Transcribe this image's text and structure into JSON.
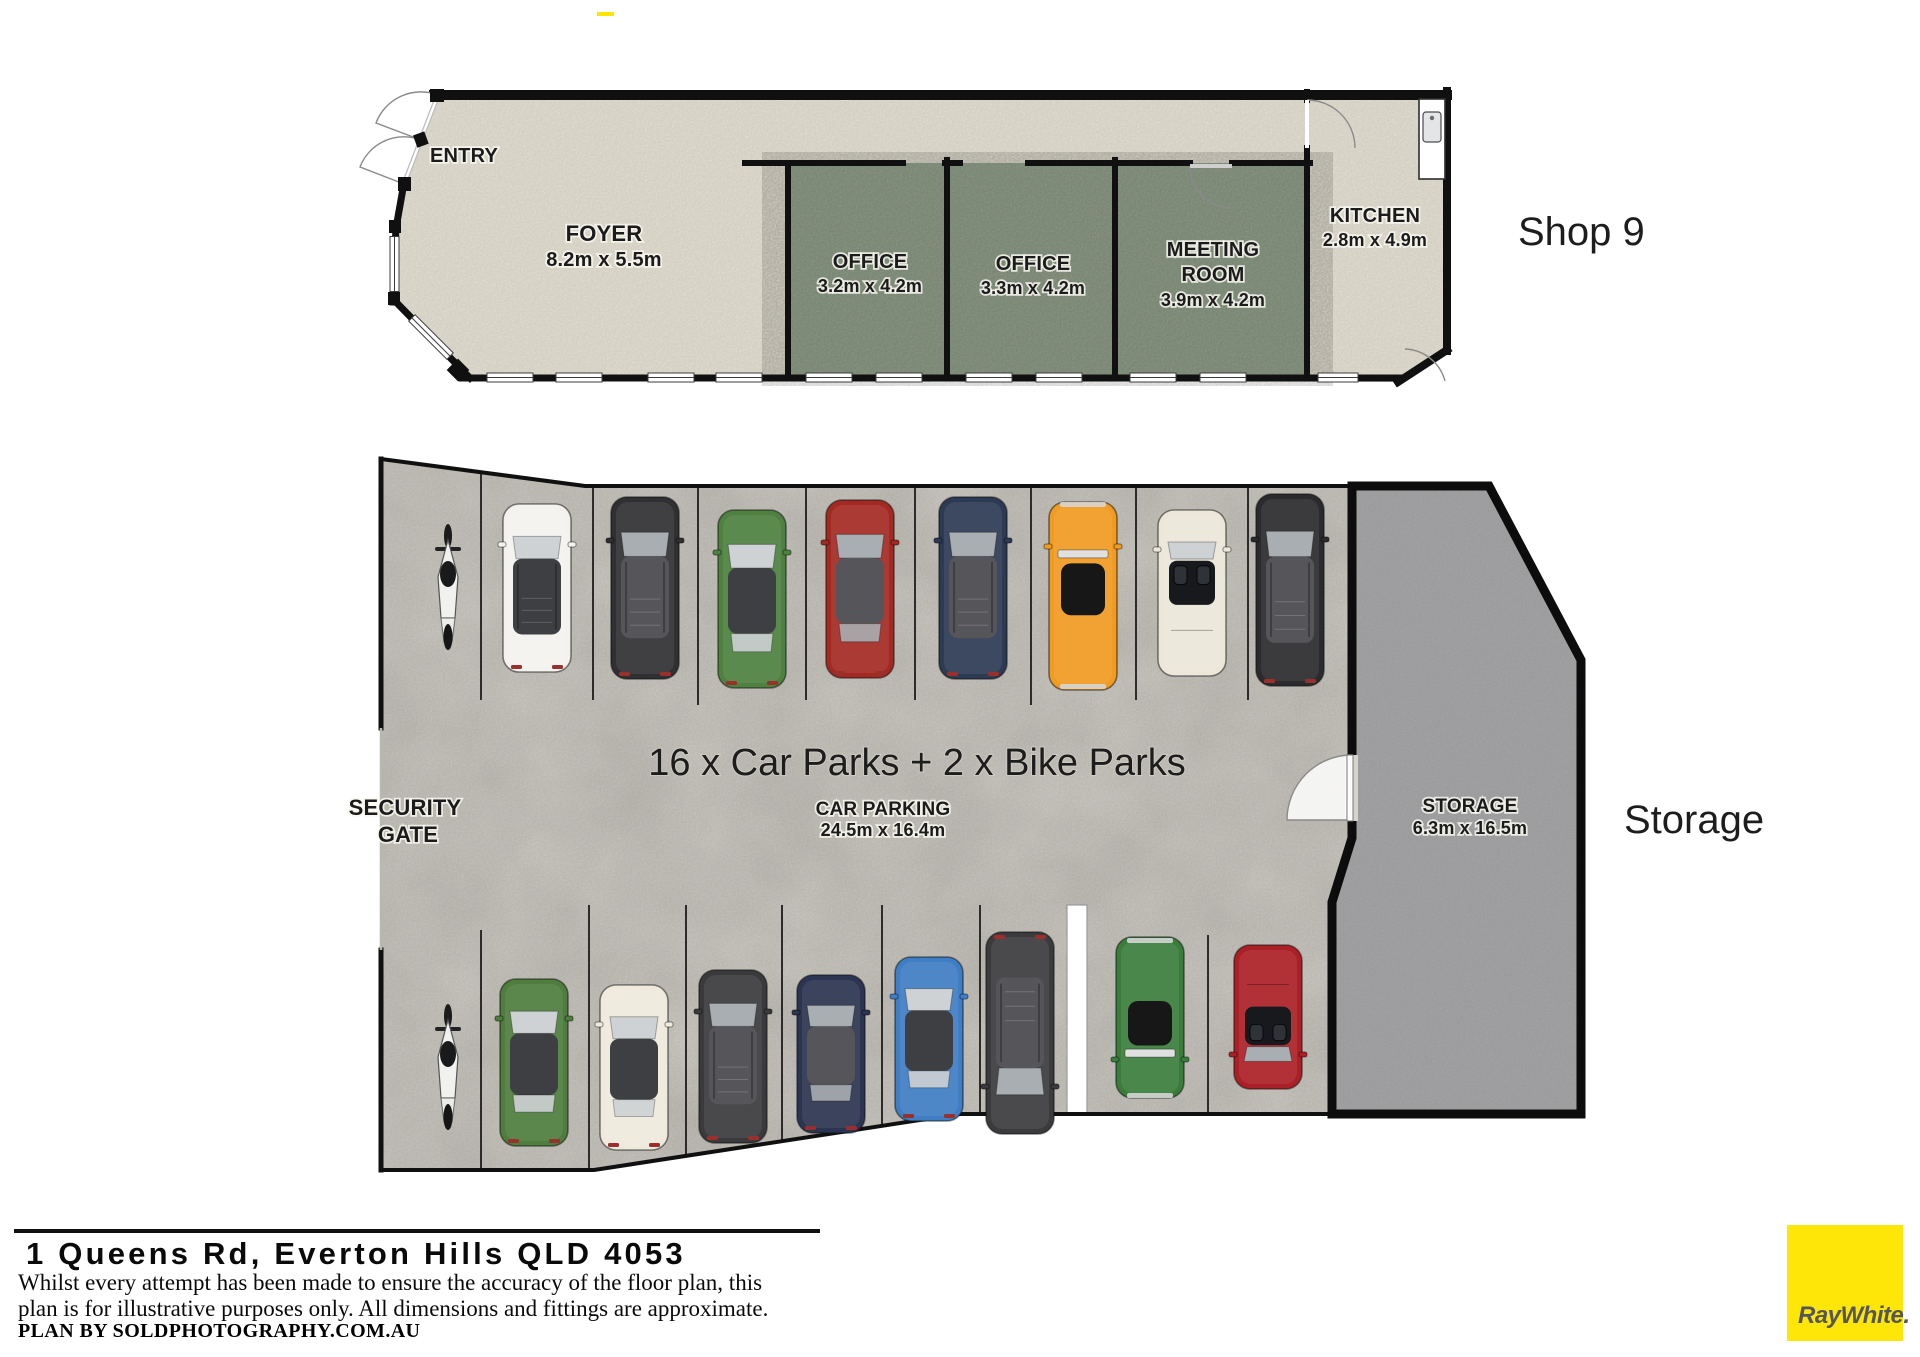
{
  "shop9": {
    "side_label": "Shop 9",
    "entry_label": "ENTRY",
    "foyer": {
      "name": "FOYER",
      "dims": "8.2m x 5.5m"
    },
    "office1": {
      "name": "OFFICE",
      "dims": "3.2m x 4.2m"
    },
    "office2": {
      "name": "OFFICE",
      "dims": "3.3m x 4.2m"
    },
    "meeting": {
      "name_line1": "MEETING",
      "name_line2": "ROOM",
      "dims": "3.9m x 4.2m"
    },
    "kitchen": {
      "name": "KITCHEN",
      "dims": "2.8m x 4.9m"
    }
  },
  "carpark": {
    "headline": "16 x Car Parks + 2 x Bike Parks",
    "label": "CAR PARKING",
    "dims": "24.5m x 16.4m",
    "security_gate_line1": "SECURITY",
    "security_gate_line2": "GATE",
    "storage": {
      "name": "STORAGE",
      "dims": "6.3m x 16.5m"
    },
    "storage_side_label": "Storage",
    "rows": {
      "top": [
        {
          "type": "suv",
          "color": "#f3f2ef",
          "desc": "white-suv"
        },
        {
          "type": "suv",
          "color": "#303032",
          "desc": "black-suv"
        },
        {
          "type": "car",
          "color": "#4e8040",
          "desc": "green-car"
        },
        {
          "type": "car",
          "color": "#a32a22",
          "desc": "red-car"
        },
        {
          "type": "suv",
          "color": "#2d3a53",
          "desc": "navy-suv"
        },
        {
          "type": "classic",
          "color": "#f09b22",
          "desc": "orange-classic-car"
        },
        {
          "type": "cabrio",
          "color": "#ece7d9",
          "desc": "cream-convertible"
        },
        {
          "type": "suv",
          "color": "#2b2b2d",
          "desc": "black-suv-2"
        }
      ],
      "bottom": [
        {
          "type": "car",
          "color": "#4e7d3d",
          "desc": "green-wagon"
        },
        {
          "type": "car",
          "color": "#efeadd",
          "desc": "white-sedan"
        },
        {
          "type": "suv",
          "color": "#3a3a3c",
          "desc": "dark-grey-suv"
        },
        {
          "type": "car",
          "color": "#2b3450",
          "desc": "navy-sedan"
        },
        {
          "type": "car",
          "color": "#3f7dc4",
          "desc": "blue-sedan"
        },
        {
          "type": "suv",
          "color": "#3b3b3d",
          "desc": "black-suv-3"
        },
        {
          "type": "classic",
          "color": "#3a7d3b",
          "desc": "green-classic-car"
        },
        {
          "type": "cabrio",
          "color": "#ab2026",
          "desc": "red-convertible"
        }
      ]
    },
    "bike_parks_count": 2
  },
  "footer": {
    "address": "1 Queens Rd, Everton Hills QLD 4053",
    "disclaimer_line1": "Whilst every attempt has been made to ensure the accuracy of the floor plan, this",
    "disclaimer_line2": "plan is for illustrative purposes only. All dimensions and fittings are approximate.",
    "plan_by": "PLAN BY SOLDPHOTOGRAPHY.COM.AU",
    "logo_text": "RayWhite."
  },
  "colors": {
    "brand_yellow": "#fde608",
    "logo_text_grey": "#54565a",
    "shop_floor_beige": "#ece8da",
    "room_green": "#93a18c",
    "carpark_floor": "#d7d4cc",
    "storage_grey": "#a9a9ab",
    "wall_black": "#101010"
  }
}
